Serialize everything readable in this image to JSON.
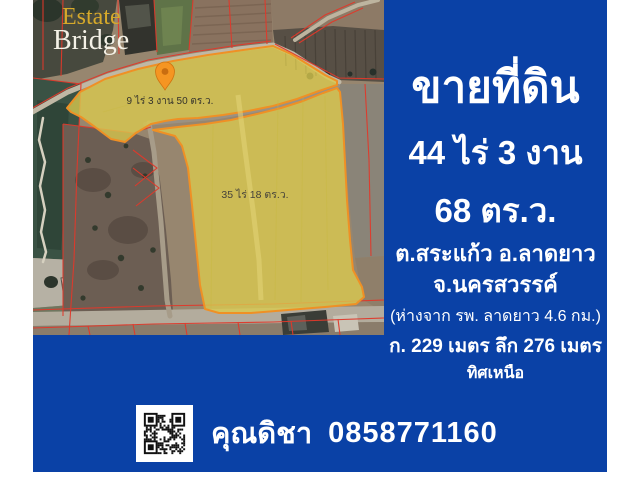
{
  "logo": {
    "line1": "Estate",
    "line2": "Bridge"
  },
  "map": {
    "plot1_label": "9 ไร่ 3 งาน 50 ตร.ว.",
    "plot2_label": "35 ไร่ 18 ตร.ว."
  },
  "panel": {
    "title": "ขายที่ดิน",
    "area_line1": "44 ไร่ 3 งาน",
    "area_line2": "68 ตร.ว.",
    "location_line1": "ต.สระแก้ว อ.ลาดยาว",
    "location_line2": "จ.นครสวรรค์",
    "distance_note": "(ห่างจาก รพ. ลาดยาว 4.6 กม.)",
    "dimensions": "ก. 229 เมตร ลึก 276 เมตร",
    "direction": "ทิศเหนือ"
  },
  "contact": {
    "name": "คุณดิชา",
    "phone": "0858771160"
  },
  "colors": {
    "panel_blue": "#0a41a6",
    "highlight_yellow": "#dbcb4e",
    "highlight_border": "#ef9025",
    "cadastral_red": "#e0392b",
    "logo_gold": "#d6a92a",
    "text_white": "#ffffff"
  }
}
